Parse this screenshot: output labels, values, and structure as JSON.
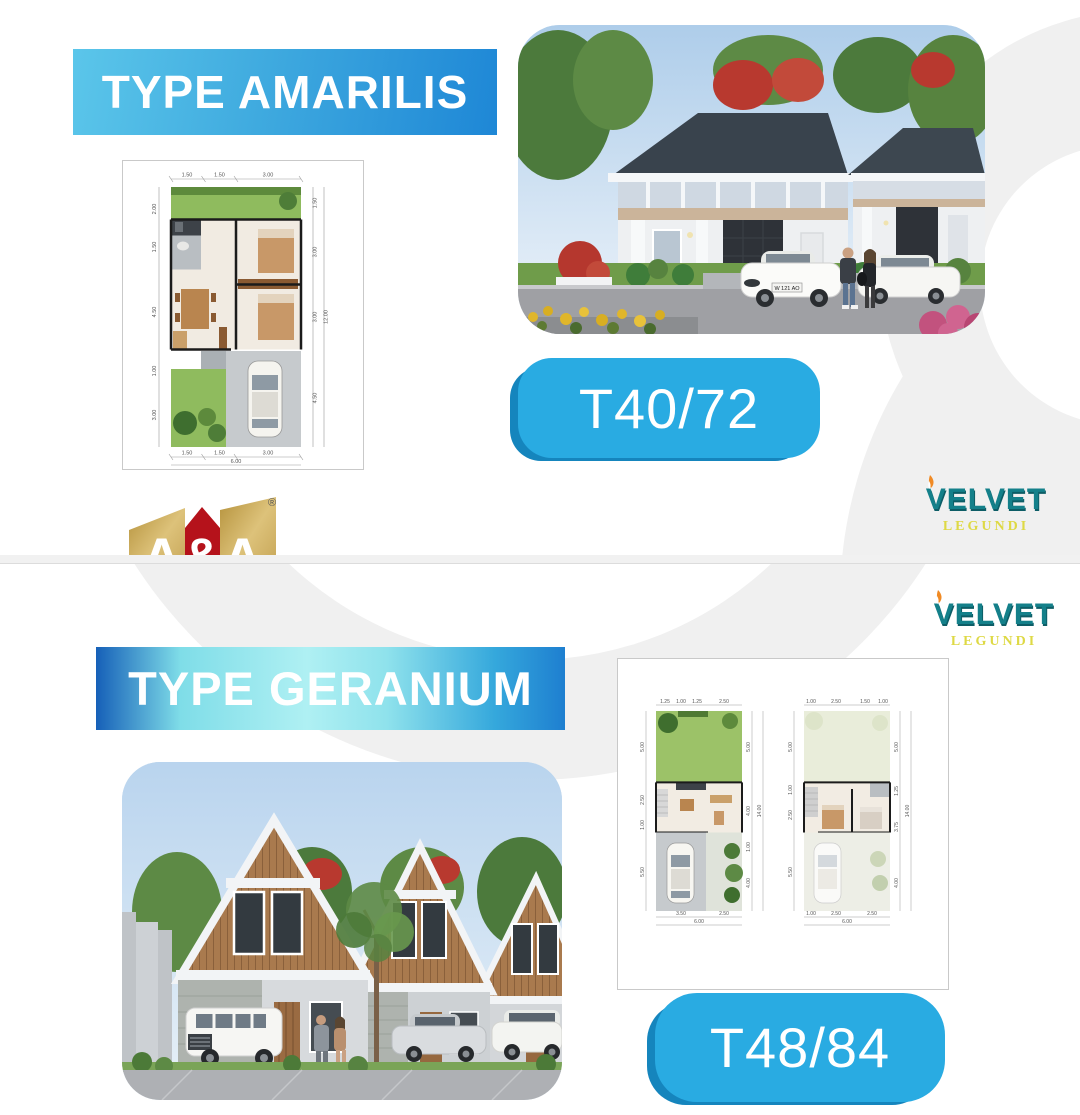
{
  "branding": {
    "aa": {
      "name": "A&A",
      "tagline": "REAL ESTATE AGENT",
      "registered": "®"
    },
    "velvet": {
      "name": "VELVET",
      "subtitle": "LEGUNDI"
    }
  },
  "amarilis": {
    "title": "TYPE AMARILIS",
    "type_label": "T40/72",
    "photo": {
      "license_plate": "W 121 AO"
    },
    "plan": {
      "top": [
        "1.50",
        "1.50",
        "3.00"
      ],
      "bottom": [
        "1.50",
        "1.50",
        "3.00"
      ],
      "bottom_total": "6.00",
      "left": [
        "2.00",
        "1.50",
        "4.50",
        "1.00",
        "3.00"
      ],
      "right": [
        "1.50",
        "3.00",
        "3.00",
        "4.50"
      ],
      "right_total": "12.00"
    }
  },
  "geranium": {
    "title": "TYPE GERANIUM",
    "type_label": "T48/84",
    "plan_ground": {
      "top": [
        "1.25",
        "1.00",
        "1.25",
        "2.50"
      ],
      "bottom": [
        "3.50",
        "2.50"
      ],
      "bottom_total": "6.00",
      "left": [
        "5.00",
        "2.50",
        "1.00",
        "5.50"
      ],
      "right": [
        "5.00",
        "4.00",
        "1.00",
        "4.00"
      ],
      "right_total": "14.00"
    },
    "plan_upper": {
      "top": [
        "1.00",
        "2.50",
        "1.50",
        "1.00"
      ],
      "bottom": [
        "1.00",
        "2.50",
        "2.50"
      ],
      "bottom_total": "6.00",
      "left": [
        "5.00",
        "1.00",
        "2.50",
        "5.50"
      ],
      "right": [
        "5.00",
        "1.25",
        "3.75",
        "4.00"
      ],
      "right_total": "14.00"
    }
  },
  "colors": {
    "accent_blue": "#29ABE2",
    "banner_blue_dark": "#1E87D6",
    "banner_cyan": "#A8EFF2",
    "logo_gold": "#C9A84F",
    "logo_red": "#BE1622",
    "velvet_teal": "#14808A",
    "velvet_yellow": "#DED945",
    "velvet_orange": "#F08A24",
    "deco_gray": "#F0F0F0"
  }
}
